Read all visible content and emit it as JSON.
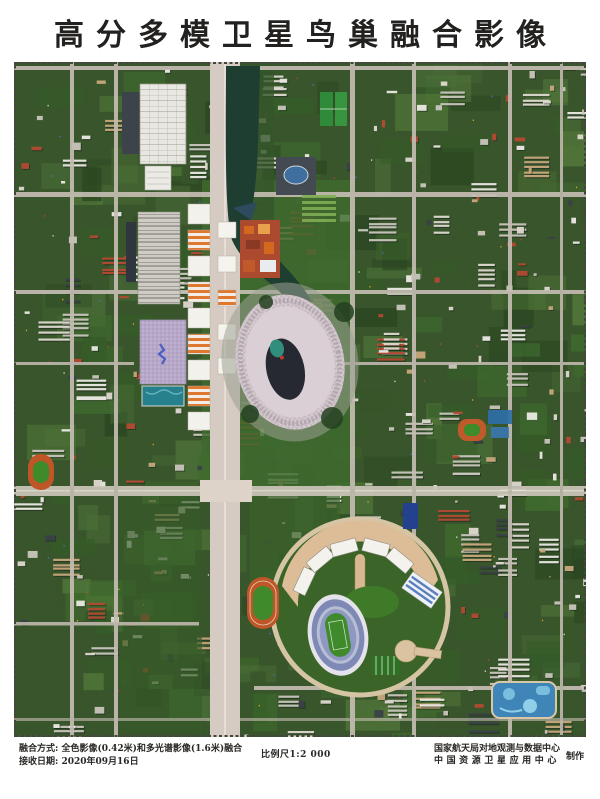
{
  "header": {
    "title": "高分多模卫星鸟巢融合影像"
  },
  "footer": {
    "fusion_label": "融合方式:",
    "fusion_value": "全色影像(0.42米)和多光谱影像(1.6米)融合",
    "date_label": "接收日期:",
    "date_value": "2020年09月16日",
    "scale_label": "比例尺",
    "scale_value": "1:2 000",
    "producer_line1": "国家航天局对地观测与数据中心",
    "producer_line2": "中国资源卫星应用中心",
    "producer_suffix": "制作"
  },
  "image": {
    "description": "高分多模卫星鸟巢融合影像",
    "palette": {
      "base": "#39552b",
      "parkGreen": "#3f6b2e",
      "darkGreen": "#2b4722",
      "treeGreen": "#355c28",
      "midGreen": "#4a6e38",
      "lightGreen": "#52783a",
      "lawn": "#7fae54",
      "road": "#c4bdb2",
      "axisRoad": "#d6cbc2",
      "river": "#1d3e31",
      "buildingWhite": "#ded9d0",
      "buildingLight": "#eceae5",
      "buildingGray": "#c9c6bd",
      "buildingDark": "#3a4148",
      "shadow": "#16231a",
      "tan": "#c8a87c",
      "brickRed": "#b34a32",
      "orange": "#d2691e",
      "waterCube": "#b6a7c8",
      "pool": "#27808e",
      "nestOuter": "#cfc3ca",
      "nestHole": "#262931",
      "stadiumBlue": "#7e89b5",
      "trackOrange": "#bf5628",
      "fieldGreen": "#3f8a2b",
      "plazaTan": "#d9bd97",
      "waterPark": "#3f85b8"
    }
  }
}
